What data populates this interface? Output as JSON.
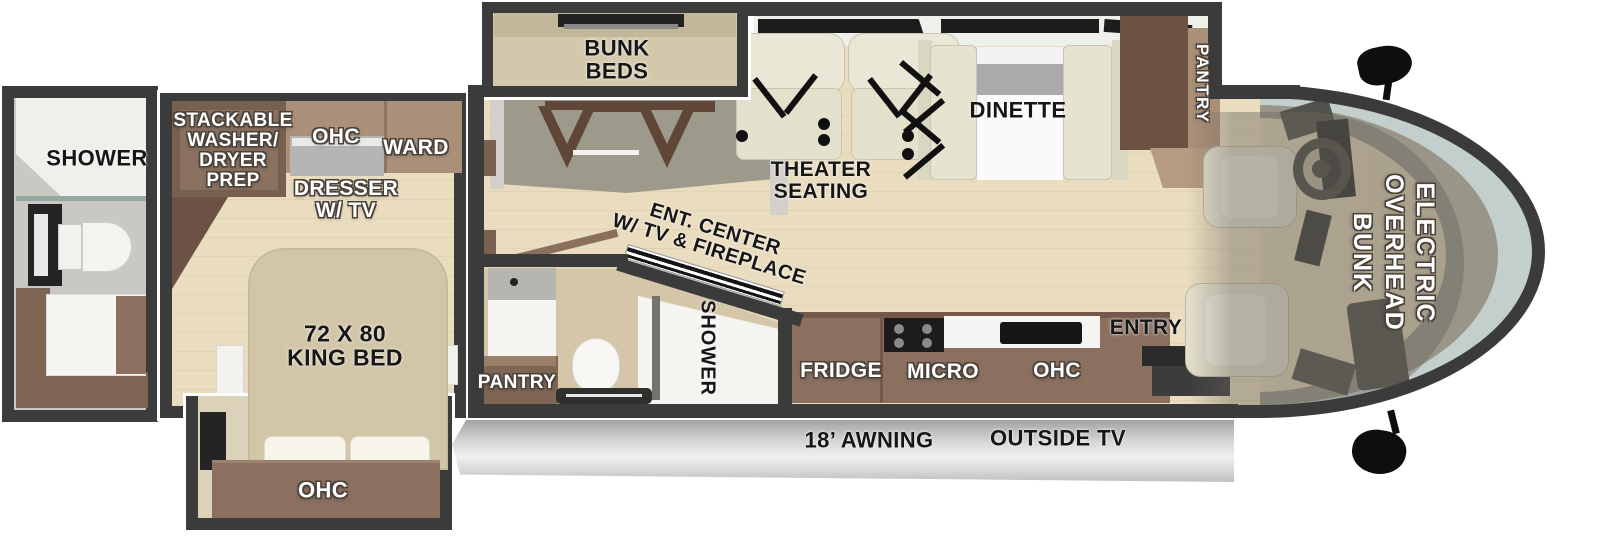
{
  "title": "RV floor plan",
  "colors": {
    "wall": "#3b3b3b",
    "floor_wood": "#e7dabd",
    "cabinet_brown": "#8b7060",
    "cabinet_dark_brown": "#78604f",
    "bed_beige": "#d2c6a8",
    "seat_cream": "#e8e5d3",
    "awning_gray": "#d6d6d6",
    "windshield": "#c3cfcd",
    "label_black": "#161616",
    "label_white": "#ffffff"
  },
  "labels": {
    "rear_bath": {
      "shower": "SHOWER"
    },
    "bedroom": {
      "washer_dryer": "STACKABLE\nWASHER/\nDRYER\nPREP",
      "ohc": "OHC",
      "ward": "WARD",
      "dresser": "DRESSER\nW/ TV",
      "king_bed": "72 X 80\nKING BED",
      "slide_ohc": "OHC"
    },
    "bunk_room": {
      "bunk_beds": "BUNK\nBEDS"
    },
    "living": {
      "theater": "THEATER\nSEATING",
      "dinette": "DINETTE",
      "pantry": "PANTRY",
      "ent_center": "ENT. CENTER\nW/ TV & FIREPLACE"
    },
    "mid_bath": {
      "shower": "SHOWER",
      "pantry": "PANTRY"
    },
    "kitchen": {
      "fridge": "FRIDGE",
      "micro": "MICRO",
      "ohc": "OHC",
      "entry": "ENTRY"
    },
    "cab": {
      "overhead_bunk": "ELECTRIC\nOVERHEAD\nBUNK"
    },
    "exterior": {
      "awning": "18’ AWNING",
      "outside_tv": "OUTSIDE TV"
    }
  }
}
